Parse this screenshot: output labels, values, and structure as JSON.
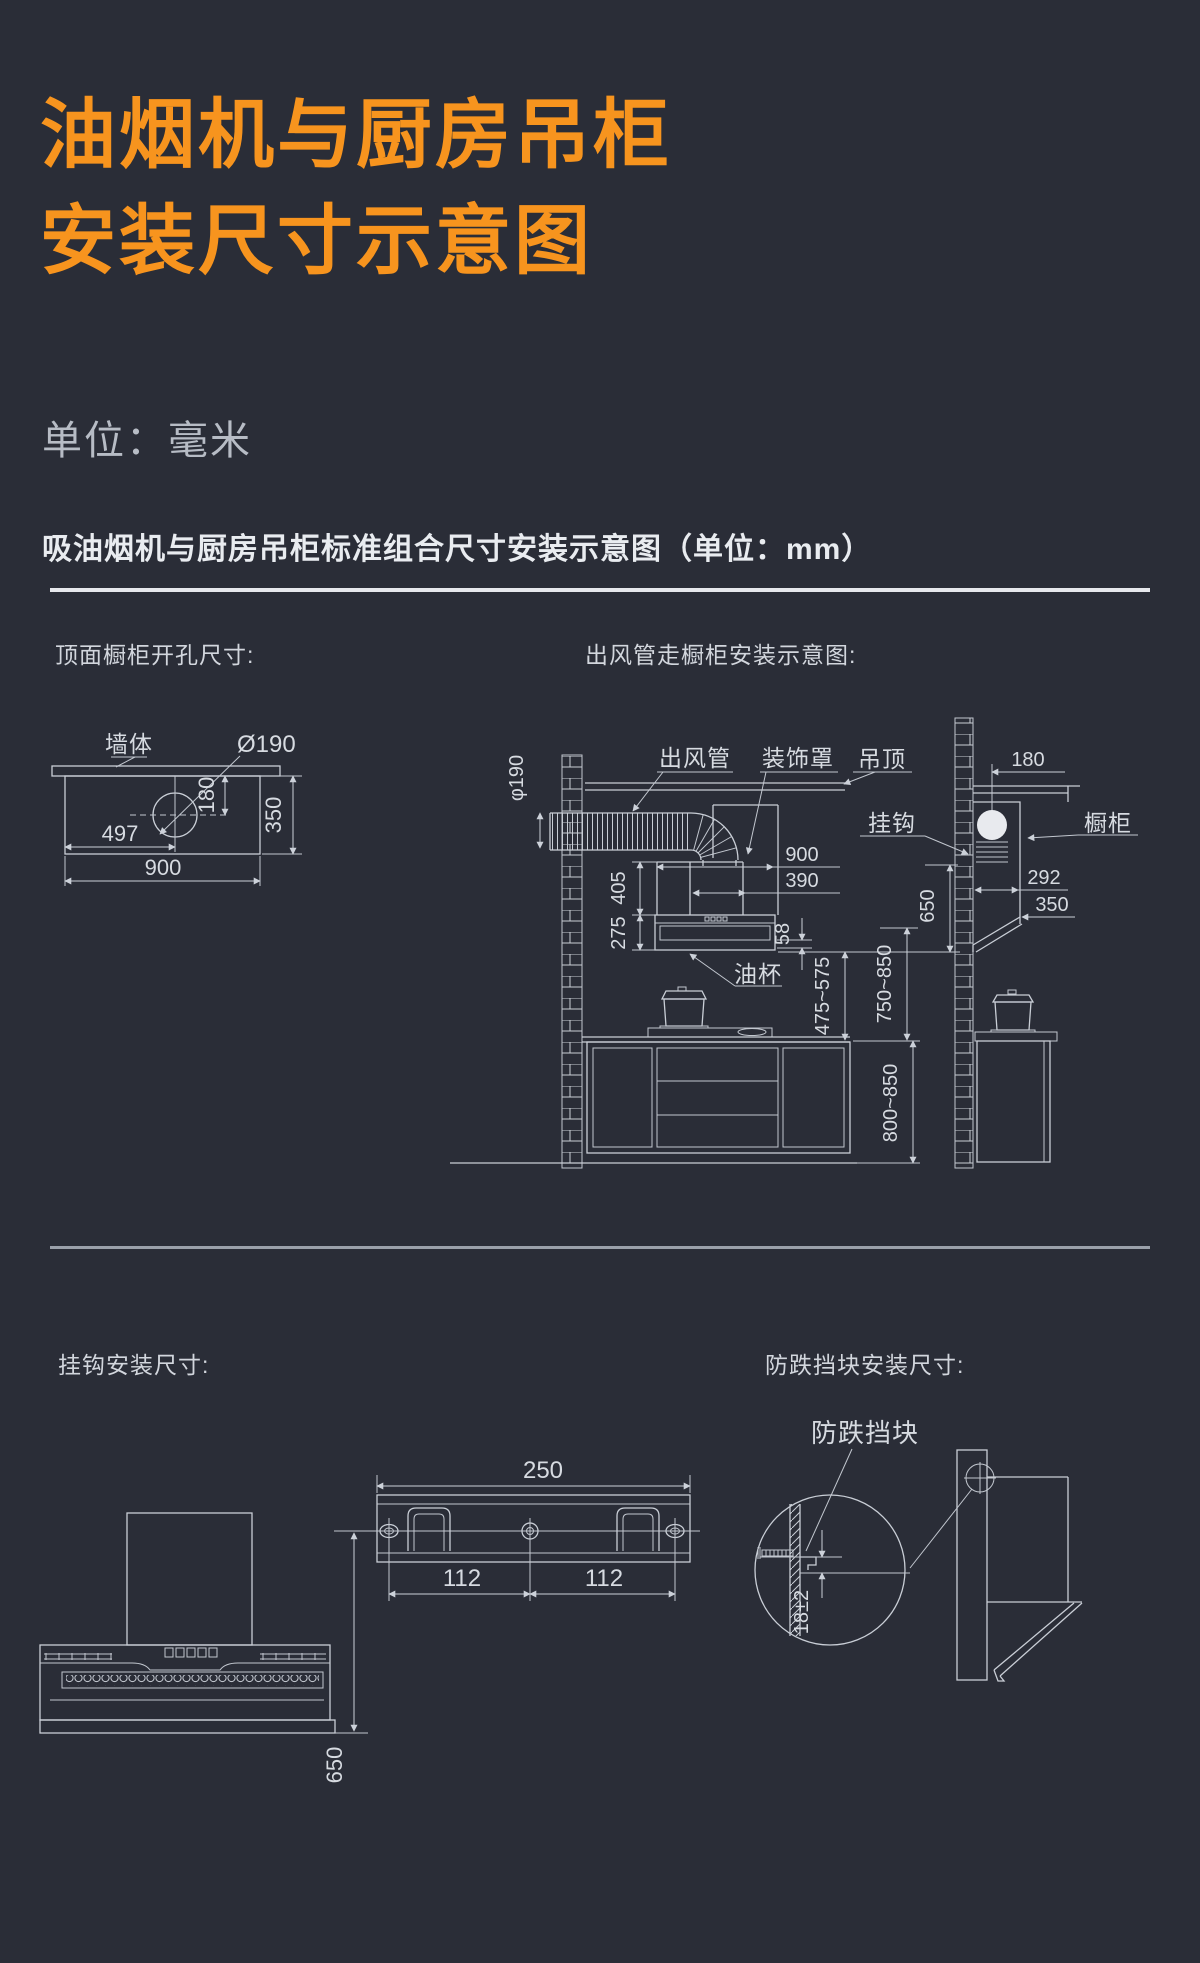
{
  "page": {
    "title_line1": "油烟机与厨房吊柜",
    "title_line2": "安装尺寸示意图",
    "unit_note": "单位：毫米",
    "section_title": "吸油烟机与厨房吊柜标准组合尺寸安装示意图（单位：mm）"
  },
  "colors": {
    "background": "#2a2d37",
    "accent_orange": "#F7941E",
    "drawing_line": "#c9ced6",
    "muted_text": "#b7bcc5"
  },
  "top_opening": {
    "heading": "顶面橱柜开孔尺寸:",
    "wall_label": "墙体",
    "hole_diameter": "Ø190",
    "dim_hole_from_left": "497",
    "dim_hole_from_wall": "180",
    "dim_depth": "350",
    "dim_width": "900"
  },
  "duct_diagram": {
    "heading": "出风管走橱柜安装示意图:",
    "duct_label": "出风管",
    "cover_label": "装饰罩",
    "ceiling_label": "吊顶",
    "hook_label": "挂钩",
    "cabinet_label": "橱柜",
    "oilcup_label": "油杯",
    "dim_duct_dia": "φ190",
    "dim_hood_width": "900",
    "dim_outlet_width": "390",
    "dim_cover_height": "405",
    "dim_hood_height": "275",
    "dim_panel_height": "58",
    "dim_hood_to_stove": "475~575",
    "dim_hook_to_counter": "750~850",
    "dim_counter_height": "800~850",
    "dim_hook_drop": "650",
    "dim_wall_offset": "180",
    "dim_cabinet_depth": "292",
    "dim_cabinet_bottom": "350"
  },
  "hook_diagram": {
    "heading": "挂钩安装尺寸:",
    "dim_bracket_width": "250",
    "dim_hole_spacing_left": "112",
    "dim_hole_spacing_right": "112",
    "dim_hook_to_bottom": "650"
  },
  "block_diagram": {
    "heading": "防跌挡块安装尺寸:",
    "block_label": "防跌挡块",
    "dim_gap": "18±2"
  }
}
